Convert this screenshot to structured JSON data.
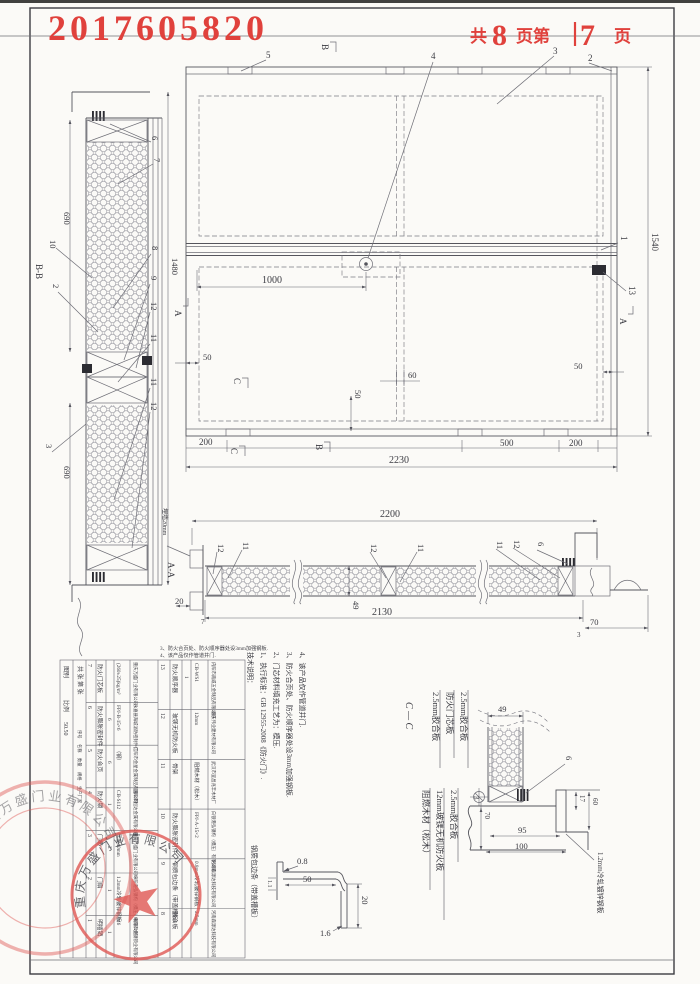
{
  "page": {
    "stamp_number": "2017605820",
    "pages_prefix": "共",
    "pages_total": "8",
    "pages_mid": "页第",
    "pages_current": "7",
    "pages_suffix": "页"
  },
  "elevation": {
    "callouts": {
      "n5": "5",
      "n4": "4",
      "n3": "3",
      "n2": "2",
      "n1": "1",
      "n13": "13"
    },
    "marks": {
      "top_b": "B",
      "inner_c": "C",
      "bottom_c": "C",
      "bottom_b": "B",
      "left_a": "A",
      "right_a": "A"
    },
    "dims": {
      "d1000": "1000",
      "d50l": "50",
      "d60": "60",
      "d50m": "50",
      "d50r": "50",
      "d200l": "200",
      "d500": "500",
      "d200r": "200",
      "d2230": "2230",
      "d1540": "1540"
    }
  },
  "section_bb": {
    "label": "B-B",
    "dims": {
      "d690t": "690",
      "d690b": "690",
      "d1480": "1480",
      "d2": "2",
      "d3": "3"
    },
    "callouts": {
      "c10": "10",
      "c6": "6",
      "c7": "7",
      "c8": "8",
      "c9": "9",
      "c12a": "12",
      "c11a": "11",
      "c11b": "11",
      "c12b": "12"
    }
  },
  "section_aa": {
    "label": "A-A",
    "wall_note": "埋墙20mm",
    "dims": {
      "d2200": "2200",
      "d2130": "2130",
      "d20": "20",
      "d7": "7",
      "d49": "49",
      "d70": "70",
      "d3": "3"
    },
    "callouts": {
      "c12a": "12",
      "c11a": "11",
      "c12b": "12",
      "c11b": "11",
      "c11c": "11",
      "c12c": "12",
      "c6": "6"
    }
  },
  "section_cc": {
    "label": "C — C",
    "callout6": "6",
    "dims": {
      "d49": "49",
      "d3": "3",
      "d70": "70",
      "d95": "95",
      "d100": "100",
      "d17": "17",
      "d60": "60"
    },
    "layers_top": [
      "2.5mm胶合板",
      "防火门芯板",
      "2.5mm胶合板"
    ],
    "layers_bottom": [
      "阻燃木材（松木）",
      "12mm玻镁无机防火板",
      "2.5mm胶合板"
    ],
    "steel_note": "1.2mm冷轧镀锌钢板"
  },
  "profile_detail": {
    "label": "钢质包边条（带盖槽板）",
    "dims": {
      "d08": "0.8",
      "d50": "50",
      "d11": "1.1",
      "d20": "20",
      "d16": "1.6"
    }
  },
  "notes": {
    "title": "技术说明：",
    "lines": [
      "1、执行标准：GB 12955-2008《防火门》.",
      "2、门芯材料填充工艺为：模压.",
      "3、防火合页处、防火顺序器处设3mm加强钢板.",
      "4、该产品仅作管道井门."
    ]
  },
  "notes_inline": [
    "3、防火合页处、防火顺序器处设3mm加强钢板.",
    "4、该产品仅作管道井门."
  ],
  "bom": {
    "headers": [
      "序号",
      "名称",
      "数量",
      "规格",
      "生产厂家"
    ],
    "titleblock": {
      "type_label": "图别",
      "scale_label": "比例",
      "scale": "50.50",
      "sheet": "共 张 第 张"
    },
    "rows": [
      {
        "no": "13",
        "name": "防火顺序器",
        "qty": "1",
        "spec": "CB-WS1",
        "maker": "内阳市南威五金制品有限公司"
      },
      {
        "no": "12",
        "name": "玻镁无机防火板",
        "qty": "",
        "spec": "12mm",
        "maker": "重庆伟业建材有限公司"
      },
      {
        "no": "11",
        "name": "骨架",
        "qty": "",
        "spec": "阻燃木材（松木）",
        "maker": "武汉市宜昌兆丰木材厂"
      },
      {
        "no": "10",
        "name": "防火膨胀密封件",
        "qty": "",
        "spec": "FPJ-A-15×2",
        "maker": "白银港弘钢构（模压）有限公司"
      },
      {
        "no": "9",
        "name": "钢质包边条（带盖槽板）",
        "qty": "",
        "spec": "0.8mm冷轧镀锌钢板",
        "maker": "河南森源达科技有限公司"
      },
      {
        "no": "8",
        "name": "胶合板",
        "qty": "",
        "spec": "2.5mm",
        "maker": "河南森源达科技有限公司"
      },
      {
        "no": "7",
        "name": "防火门芯板",
        "qty": "",
        "spec": "(260±25)kg/m³",
        "maker": "重庆万盛门业有限公司"
      },
      {
        "no": "6",
        "name": "防火膨胀密封件",
        "qty": "6",
        "spec": "FPJ-B-15×6",
        "maker": "永嘉县海城消防密封件厂"
      },
      {
        "no": "5",
        "name": "防火合页",
        "qty": "6",
        "spec": "（钢）",
        "maker": "信阳市金星金属制品有限公司"
      },
      {
        "no": "4",
        "name": "防火锁",
        "qty": "1",
        "spec": "CB-S112",
        "maker": "国阳市恒达金属有限公司"
      },
      {
        "no": "3",
        "name": "门框",
        "qty": "2",
        "spec": "厚度40mm",
        "maker": "重庆万盛门业有限公司"
      },
      {
        "no": "2",
        "name": "门扇",
        "qty": "1",
        "spec": "1.2mm冷轧镀锌钢板",
        "maker": "绵阳港弘钢构（模压）有限公司"
      },
      {
        "no": "1",
        "name": "明插销",
        "qty": "1",
        "spec": "M6",
        "maker": "绵阳市金钢锁业有限公司"
      }
    ]
  },
  "stamps": {
    "ring_text": "重庆万盛门业有限公司"
  }
}
